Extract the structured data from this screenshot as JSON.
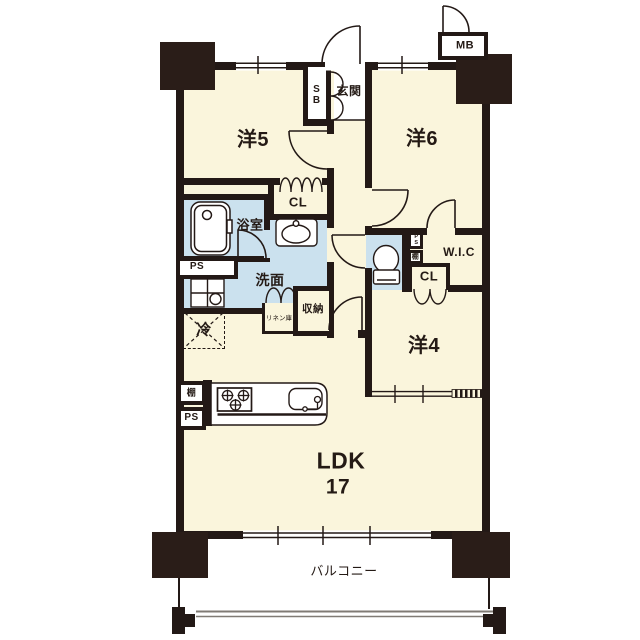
{
  "plan": {
    "rooms": {
      "yo5": "洋5",
      "yo6": "洋6",
      "yo4": "洋4",
      "ldk": "LDK",
      "ldk_size": "17",
      "genkan": "玄関",
      "bath": "浴室",
      "wash": "洗面",
      "wic": "W.I.C",
      "balcony": "バルコニー"
    },
    "closets": {
      "cl_west": "CL",
      "cl_east": "CL",
      "shuno": "収納",
      "linen": "リネン庫",
      "sb": "SB"
    },
    "utility": {
      "mb": "MB",
      "ps_bath": "PS",
      "ps_kitchen": "PS",
      "ps_toilet": "PS",
      "shelf_kitchen": "棚",
      "shelf_toilet": "棚",
      "fridge": "冷"
    },
    "fixtures": [
      "bathtub",
      "washbasin",
      "washing-machine-pan",
      "toilet",
      "kitchen-counter",
      "stove",
      "kitchen-sink",
      "refrigerator-space"
    ],
    "colors": {
      "floor": "#FAF5DC",
      "wet_area": "#CBE1EE",
      "wall": "#231916",
      "railing": "#807B75"
    }
  }
}
